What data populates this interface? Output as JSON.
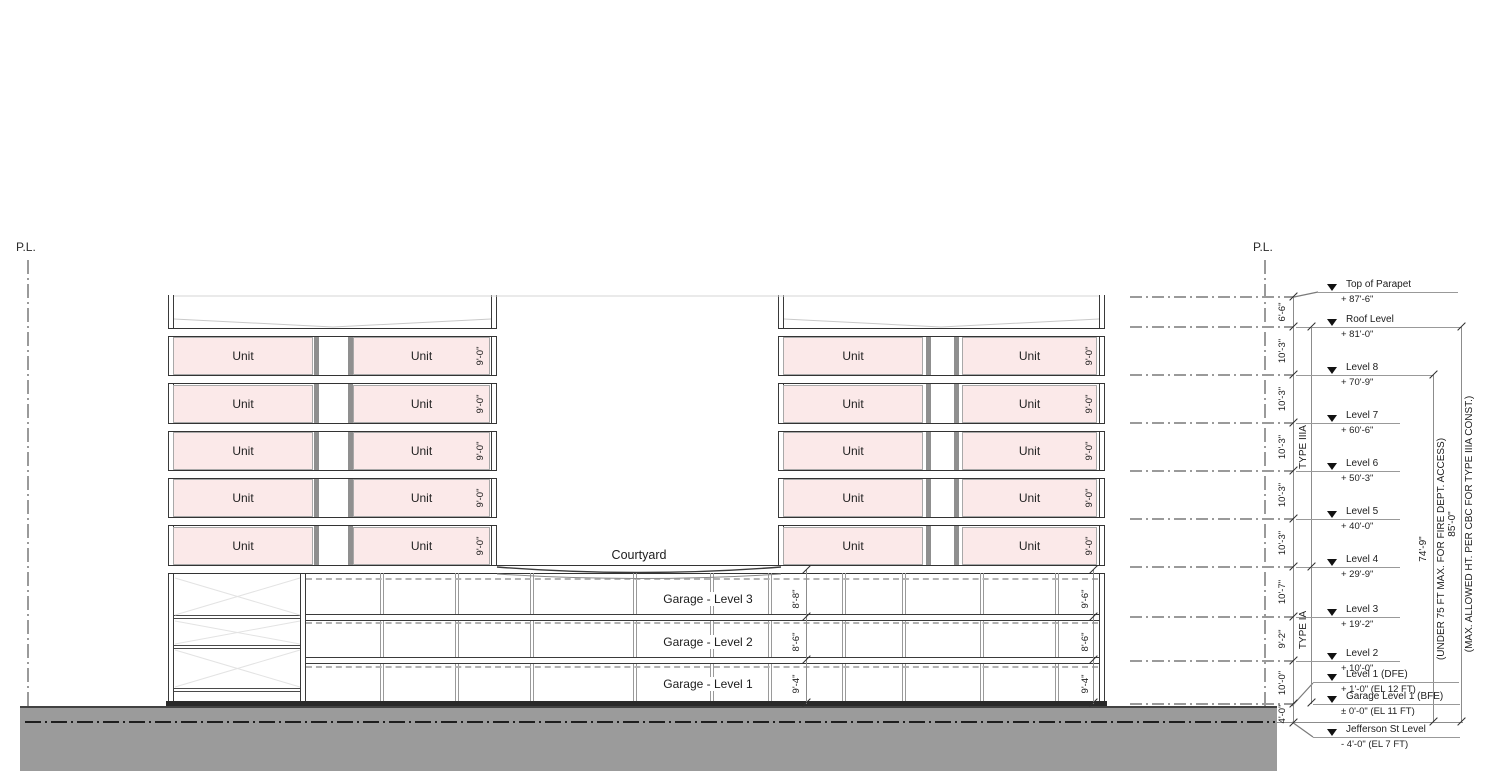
{
  "drawing": {
    "property_line_label": "P.L.",
    "unit_label": "Unit",
    "unit_height_dim": "9'-0\"",
    "courtyard_label": "Courtyard",
    "colors": {
      "unit_fill": "#fbe9e9",
      "ground": "#9b9b9b",
      "line_dark": "#2e2e2e"
    },
    "unit_rows": [
      {
        "y": 356
      },
      {
        "y": 404
      },
      {
        "y": 451
      },
      {
        "y": 498
      },
      {
        "y": 546
      }
    ],
    "garage_rows": [
      {
        "label": "Garage - Level 3",
        "mid": "8'-8\"",
        "right": "9'-6\"",
        "y": 599
      },
      {
        "label": "Garage - Level 2",
        "mid": "8'-6\"",
        "right": "8'-6\"",
        "y": 642
      },
      {
        "label": "Garage - Level 1",
        "mid": "9'-4\"",
        "right": "9'-4\"",
        "y": 684
      }
    ],
    "levels": [
      {
        "name": "Top of Parapet",
        "elev": "+ 87'-6\"",
        "y": 297,
        "my": 292,
        "x": 1318,
        "w": 140,
        "dash": true,
        "tick": true
      },
      {
        "name": "Roof Level",
        "elev": "+ 81'-0\"",
        "y": 327,
        "my": 327,
        "x": 1296,
        "w": 165,
        "dash": true,
        "tick": true
      },
      {
        "name": "Level 8",
        "elev": "+ 70'-9\"",
        "y": 375,
        "my": 375,
        "x": 1296,
        "w": 137,
        "dash": true,
        "tick": true
      },
      {
        "name": "Level 7",
        "elev": "+ 60'-6\"",
        "y": 423,
        "my": 423,
        "x": 1296,
        "w": 104,
        "dash": true,
        "tick": true
      },
      {
        "name": "Level 6",
        "elev": "+ 50'-3\"",
        "y": 471,
        "my": 471,
        "x": 1296,
        "w": 104,
        "dash": true,
        "tick": true
      },
      {
        "name": "Level 5",
        "elev": "+ 40'-0\"",
        "y": 519,
        "my": 519,
        "x": 1296,
        "w": 104,
        "dash": true,
        "tick": true
      },
      {
        "name": "Level 4",
        "elev": "+ 29'-9\"",
        "y": 567,
        "my": 567,
        "x": 1296,
        "w": 104,
        "dash": true,
        "tick": true
      },
      {
        "name": "Level 3",
        "elev": "+ 19'-2\"",
        "y": 617,
        "my": 617,
        "x": 1296,
        "w": 104,
        "dash": true,
        "tick": true
      },
      {
        "name": "Level 2",
        "elev": "+ 10'-0\"",
        "y": 661,
        "my": 661,
        "x": 1296,
        "w": 104,
        "dash": true,
        "tick": true
      },
      {
        "name": "Level 1 (DFE)",
        "elev": "+ 1'-0\" (EL 12 FT)",
        "y": 700,
        "my": 682,
        "x": 1313,
        "w": 146,
        "dash": false,
        "tick": false
      },
      {
        "name": "Garage Level 1 (BFE)",
        "elev": "± 0'-0\" (EL 11 FT)",
        "y": 704,
        "my": 704,
        "x": 1313,
        "w": 147,
        "dash": true,
        "tick": true
      },
      {
        "name": "Jefferson St Level",
        "elev": "- 4'-0\" (EL 7 FT)",
        "y": 723,
        "my": 737,
        "x": 1313,
        "w": 147,
        "dash": false,
        "tick": true
      }
    ],
    "wall_dims": [
      {
        "t": "6'-6\"",
        "y": 312
      },
      {
        "t": "10'-3\"",
        "y": 351
      },
      {
        "t": "10'-3\"",
        "y": 399
      },
      {
        "t": "10'-3\"",
        "y": 447
      },
      {
        "t": "10'-3\"",
        "y": 495
      },
      {
        "t": "10'-3\"",
        "y": 543
      },
      {
        "t": "10'-7\"",
        "y": 592
      },
      {
        "t": "9'-2\"",
        "y": 639
      },
      {
        "t": "10'-0\"",
        "y": 683
      },
      {
        "t": "4'-0\"",
        "y": 714
      }
    ],
    "type_labels": [
      {
        "t": "TYPE IIIA",
        "y": 447
      },
      {
        "t": "TYPE IA",
        "y": 630
      }
    ],
    "height_dims": [
      {
        "value": "74'-9\"",
        "note": "(UNDER 75 FT MAX. FOR FIRE DEPT. ACCESS)"
      },
      {
        "value": "85'-0\"",
        "note": "(MAX. ALLOWED HT. PER CBC FOR TYPE IIIA CONST.)"
      }
    ],
    "dim_ticks": [
      {
        "x": 806,
        "y": 570
      },
      {
        "x": 806,
        "y": 617
      },
      {
        "x": 806,
        "y": 660
      },
      {
        "x": 806,
        "y": 703
      },
      {
        "x": 1093,
        "y": 570
      },
      {
        "x": 1093,
        "y": 617
      },
      {
        "x": 1093,
        "y": 660
      },
      {
        "x": 1093,
        "y": 703
      },
      {
        "x": 1311,
        "y": 327
      },
      {
        "x": 1311,
        "y": 567
      },
      {
        "x": 1311,
        "y": 703
      },
      {
        "x": 1433,
        "y": 375
      },
      {
        "x": 1433,
        "y": 722
      },
      {
        "x": 1461,
        "y": 327
      },
      {
        "x": 1461,
        "y": 722
      }
    ]
  }
}
